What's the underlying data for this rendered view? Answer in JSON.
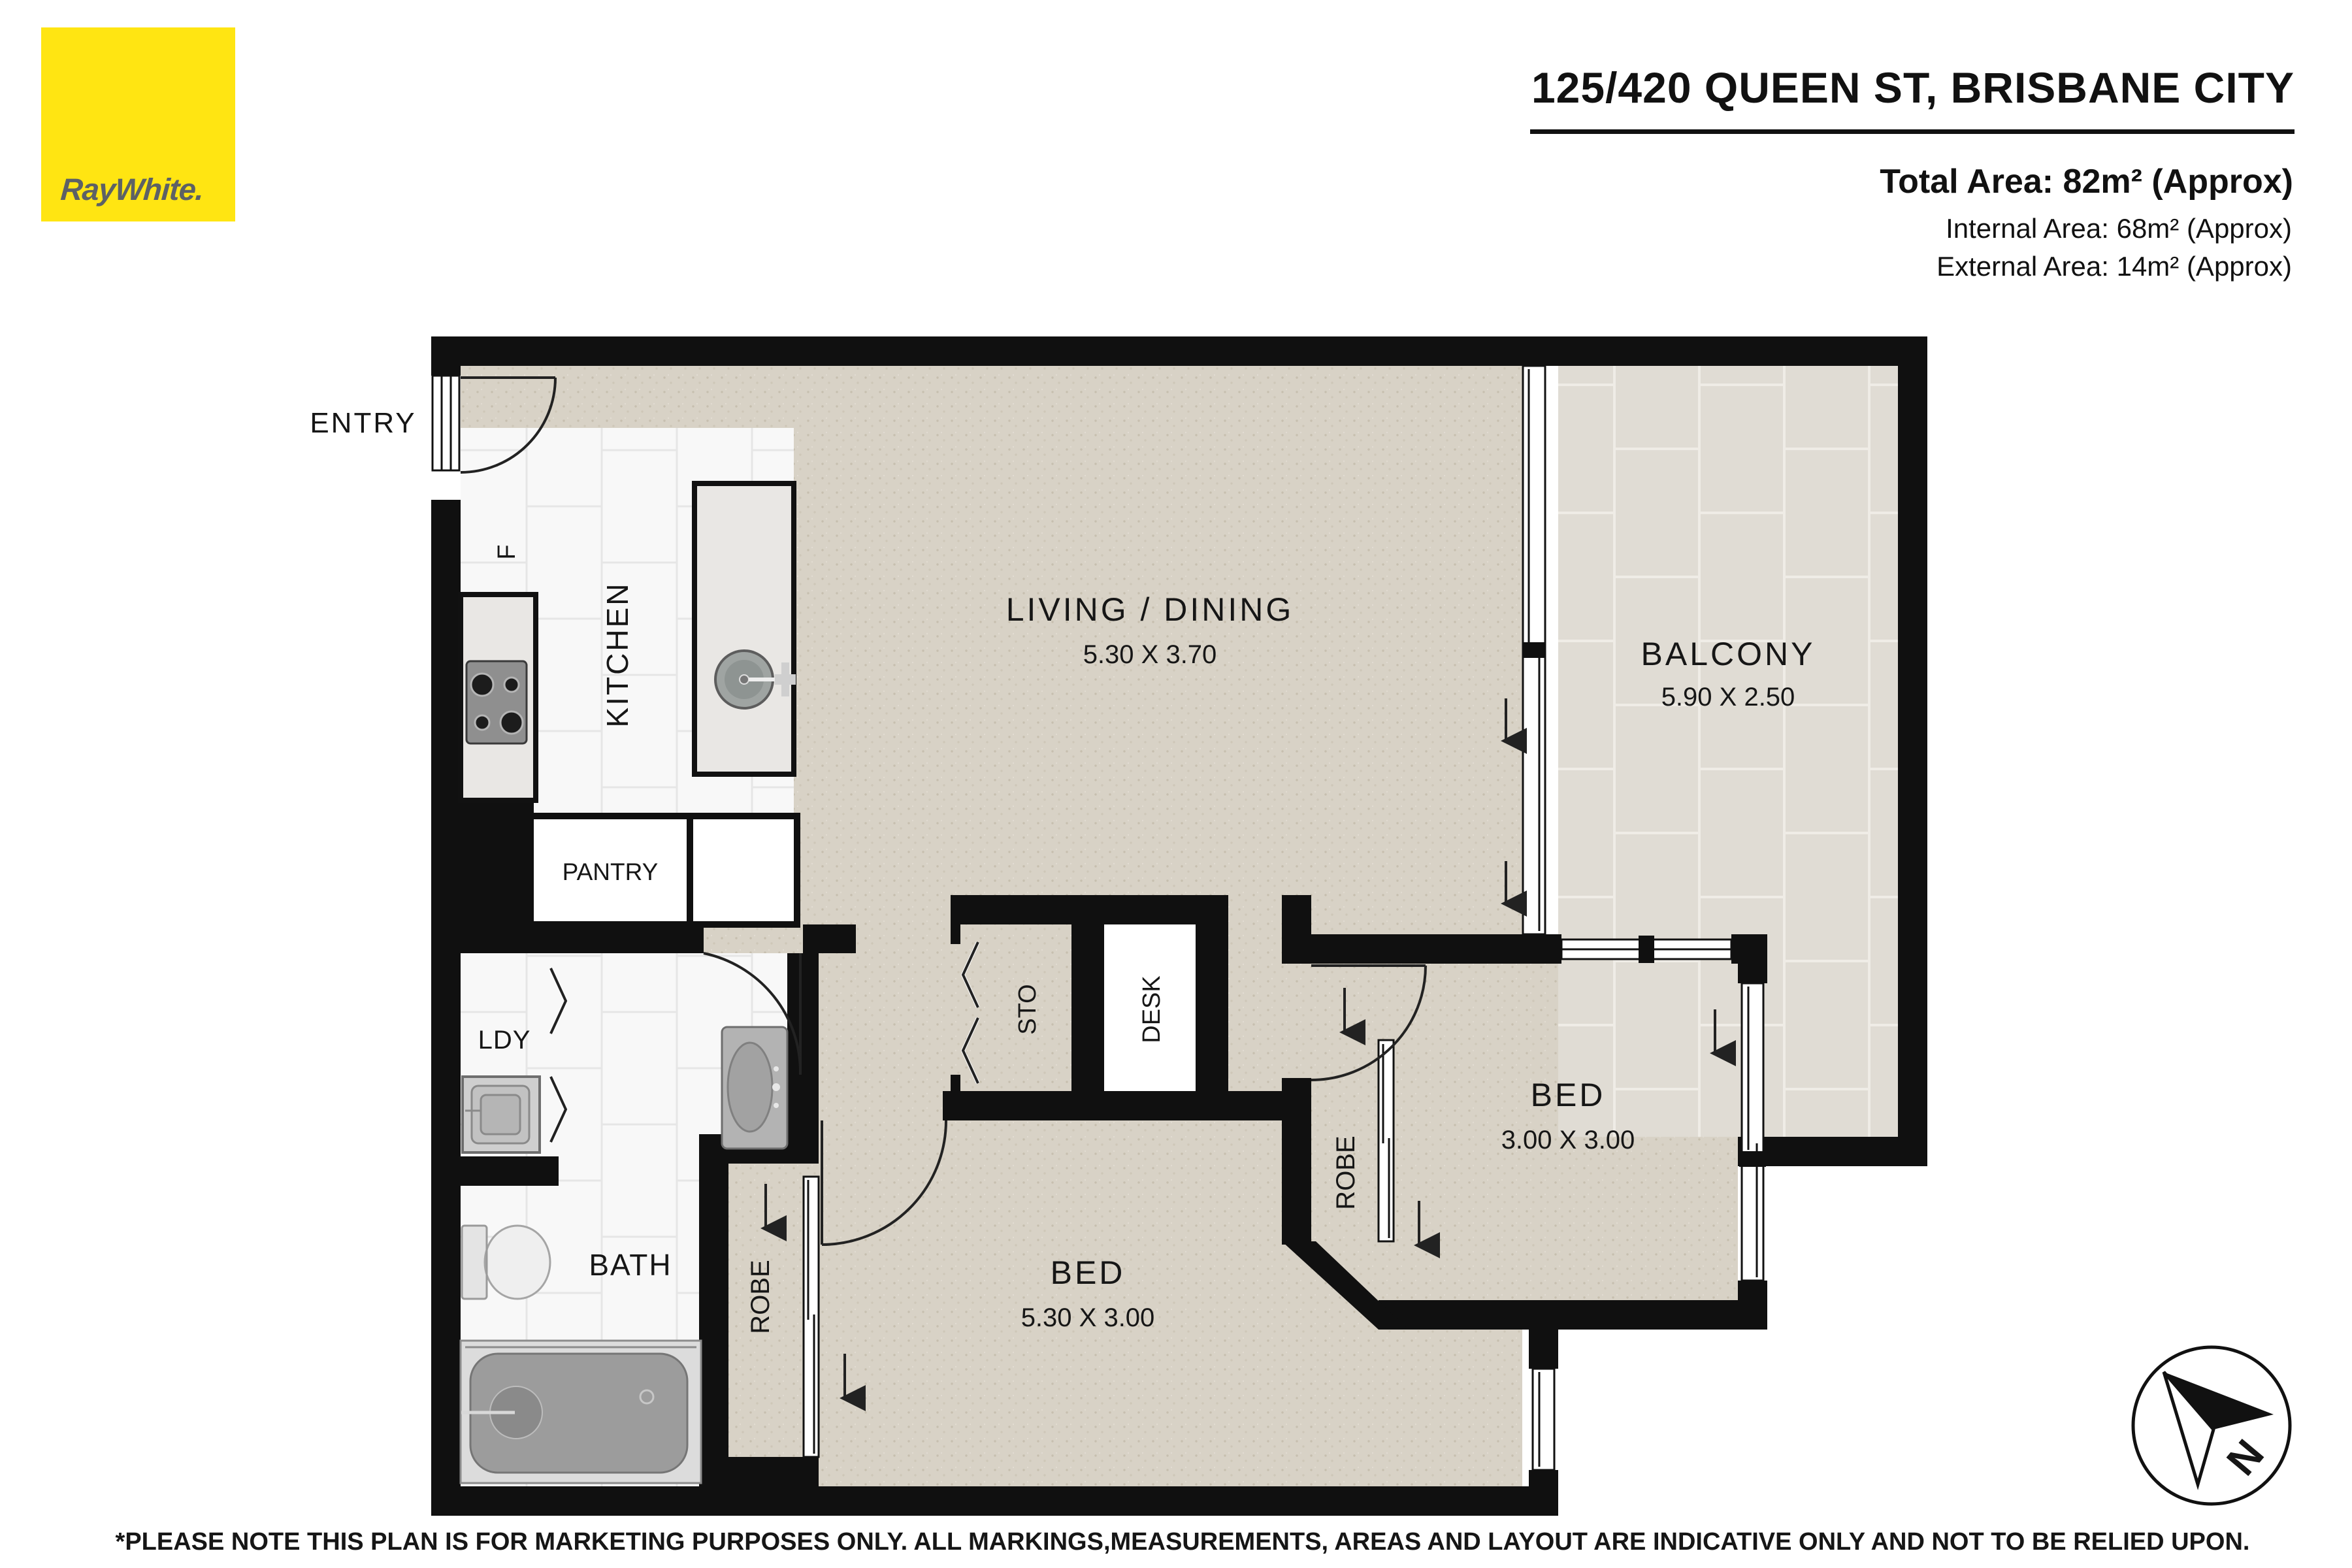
{
  "header": {
    "address": "125/420 QUEEN ST, BRISBANE CITY",
    "total_area": "Total Area: 82m² (Approx)",
    "internal_area": "Internal Area: 68m² (Approx)",
    "external_area": "External Area: 14m² (Approx)"
  },
  "logo": {
    "brand": "RayWhite."
  },
  "rooms": {
    "entry": {
      "label": "ENTRY"
    },
    "kitchen": {
      "label": "KITCHEN"
    },
    "fridge": {
      "label": "F"
    },
    "pantry": {
      "label": "PANTRY"
    },
    "living": {
      "label": "LIVING / DINING",
      "dim": "5.30 X 3.70"
    },
    "balcony": {
      "label": "BALCONY",
      "dim": "5.90 X 2.50"
    },
    "storage": {
      "label": "STO"
    },
    "desk": {
      "label": "DESK"
    },
    "laundry": {
      "label": "LDY"
    },
    "bath": {
      "label": "BATH"
    },
    "robe1": {
      "label": "ROBE"
    },
    "robe2": {
      "label": "ROBE"
    },
    "bed1": {
      "label": "BED",
      "dim": "5.30 X 3.00"
    },
    "bed2": {
      "label": "BED",
      "dim": "3.00 X 3.00"
    }
  },
  "compass": {
    "north_label": "N"
  },
  "footer": {
    "disclaimer": "*PLEASE NOTE THIS PLAN IS FOR MARKETING PURPOSES ONLY. ALL MARKINGS,MEASUREMENTS, AREAS AND LAYOUT ARE INDICATIVE ONLY AND NOT TO BE RELIED UPON."
  },
  "colors": {
    "brand_yellow": "#FFE512",
    "logo_gray": "#5D6165",
    "wall": "#101010",
    "carpet": "#D8D2C6",
    "balcony_tile": "#E0DCD4",
    "tile_white": "#F8F8F8"
  }
}
